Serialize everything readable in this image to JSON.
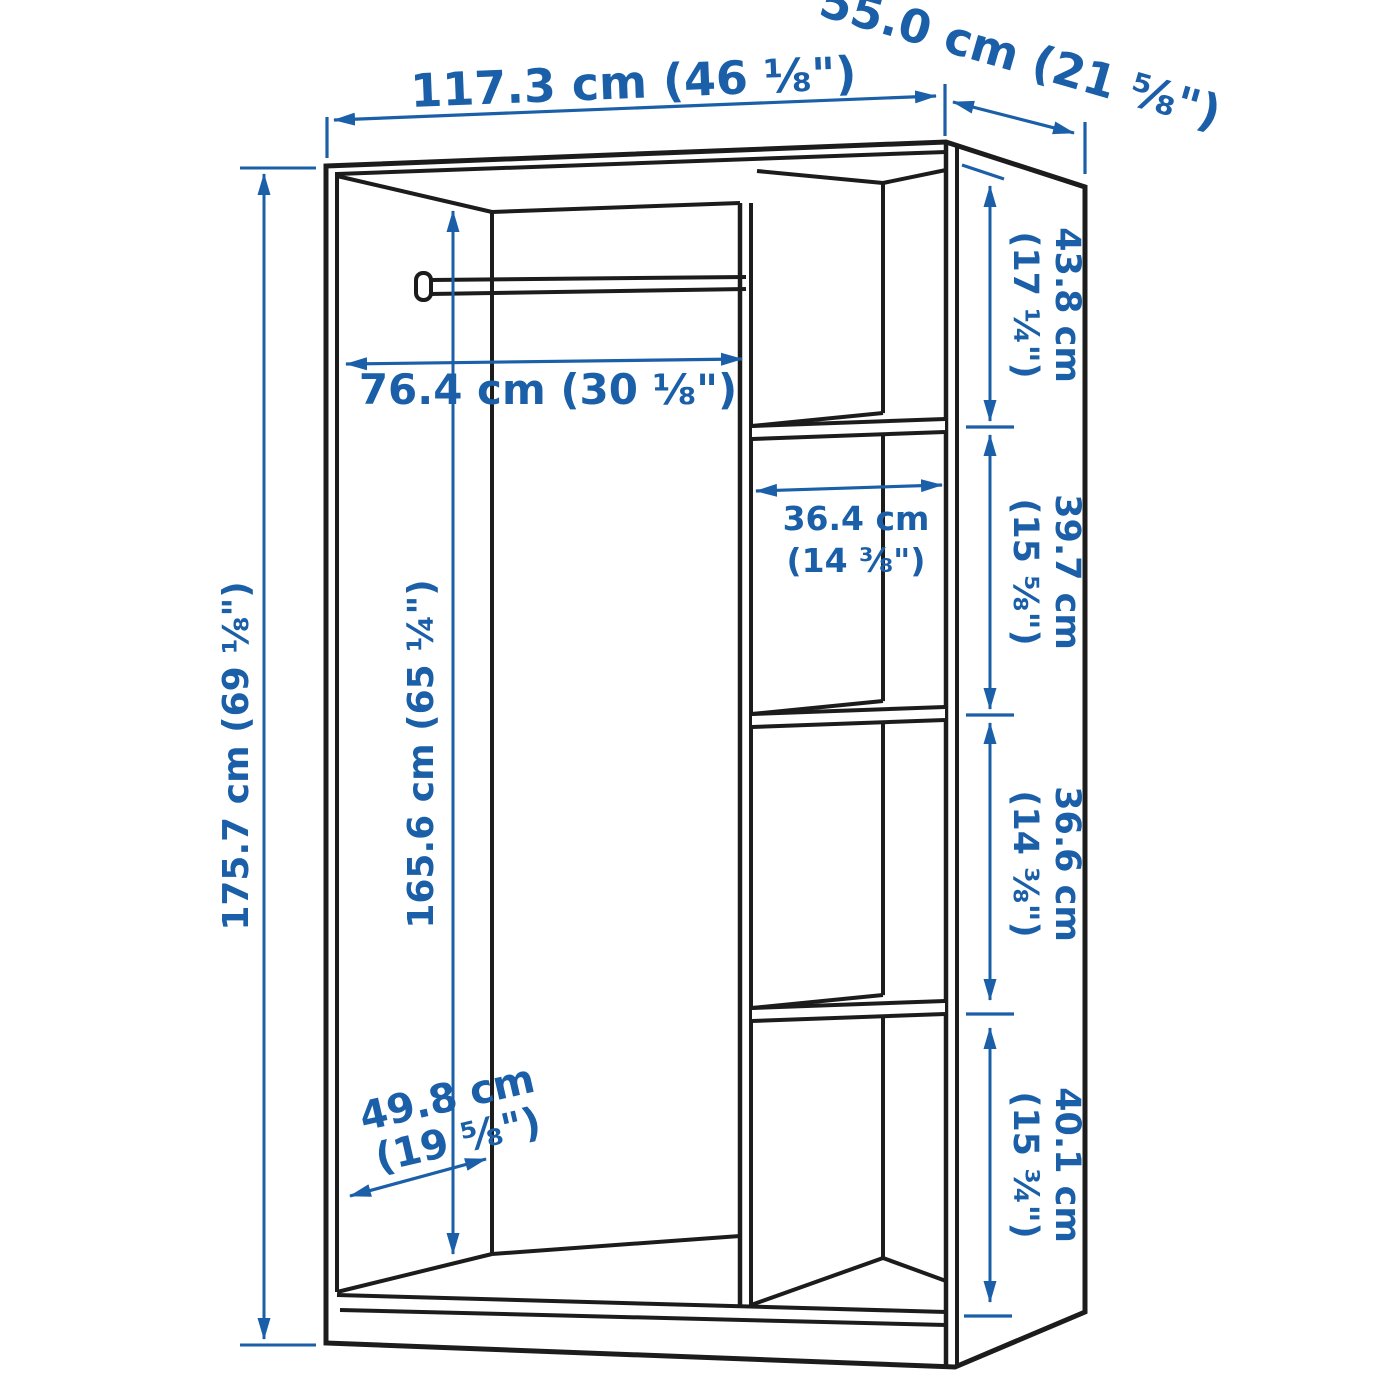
{
  "title": "Wardrobe interior dimension diagram",
  "colors": {
    "dimension_blue": "#1a5fa8",
    "outline_black": "#1c1c1c",
    "background": "#ffffff"
  },
  "labels": {
    "overall_width": "117.3 cm (46 ⅛\")",
    "overall_depth": "55.0 cm (21 ⅝\")",
    "overall_height": "175.7 cm (69 ⅛\")",
    "interior_height": "165.6 cm (65 ¼\")",
    "rail_length": "76.4 cm (30 ⅛\")",
    "interior_depth_line1": "49.8 cm",
    "interior_depth_line2": "(19 ⅝\")",
    "shelf_width_line1": "36.4 cm",
    "shelf_width_line2": "(14 ⅜\")",
    "compartment1_line1": "43.8 cm",
    "compartment1_line2": "(17 ¼\")",
    "compartment2_line1": "39.7 cm",
    "compartment2_line2": "(15 ⅝\")",
    "compartment3_line1": "36.6 cm",
    "compartment3_line2": "(14 ⅜\")",
    "compartment4_line1": "40.1 cm",
    "compartment4_line2": "(15 ¾\")"
  }
}
